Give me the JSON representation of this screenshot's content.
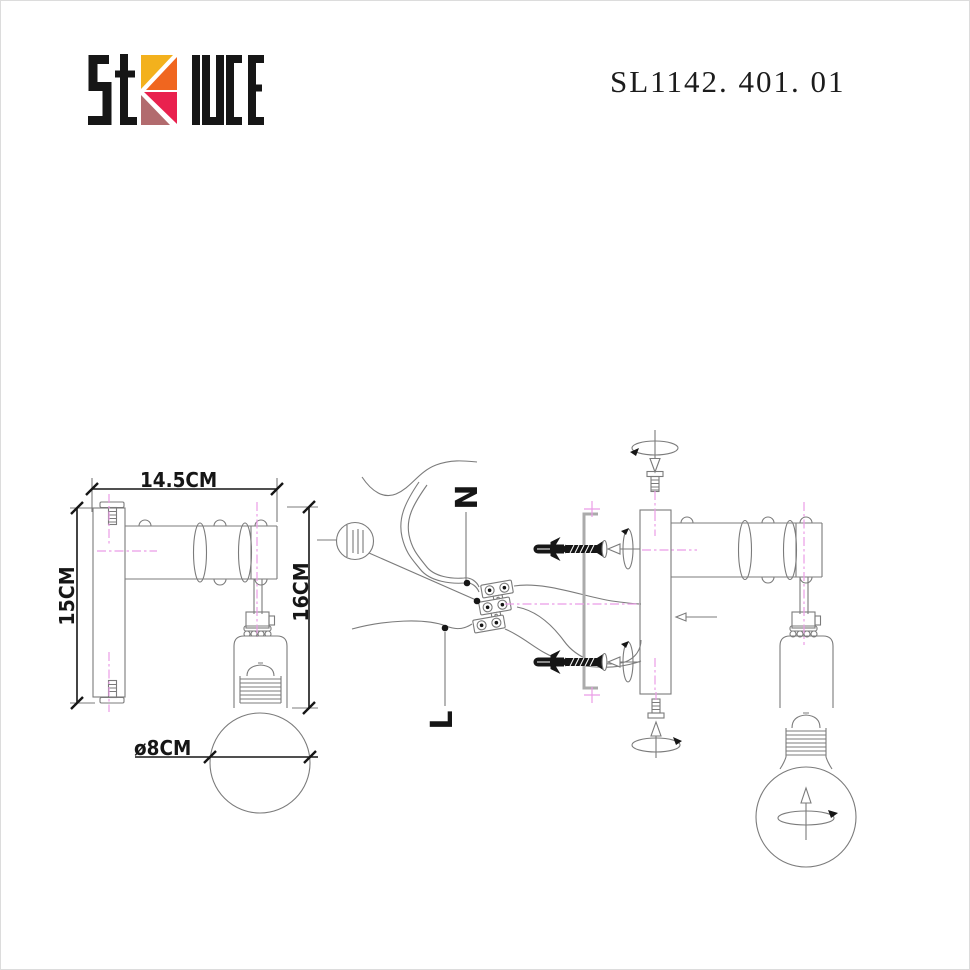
{
  "page": {
    "model_number": "SL1142. 401. 01"
  },
  "logo": {
    "part1": "St",
    "part2": "luce",
    "text": "St luce"
  },
  "left_drawing": {
    "dim_width": "14.5CM",
    "dim_plate_height": "15CM",
    "dim_drop_height": "16CM",
    "dim_bulb_diameter": "ø8CM"
  },
  "installation_diagram": {
    "neutral_wire_label": "N",
    "live_wire_label": "L"
  },
  "colors": {
    "line": "#7b7b7b",
    "ink": "#161616",
    "centerline": "#eb9ce6",
    "bracket": "#ababab",
    "logo_yellow": "#F3B11D",
    "logo_orange": "#F0661F",
    "logo_crimson": "#E9214E",
    "logo_mauve": "#B26B6E"
  }
}
